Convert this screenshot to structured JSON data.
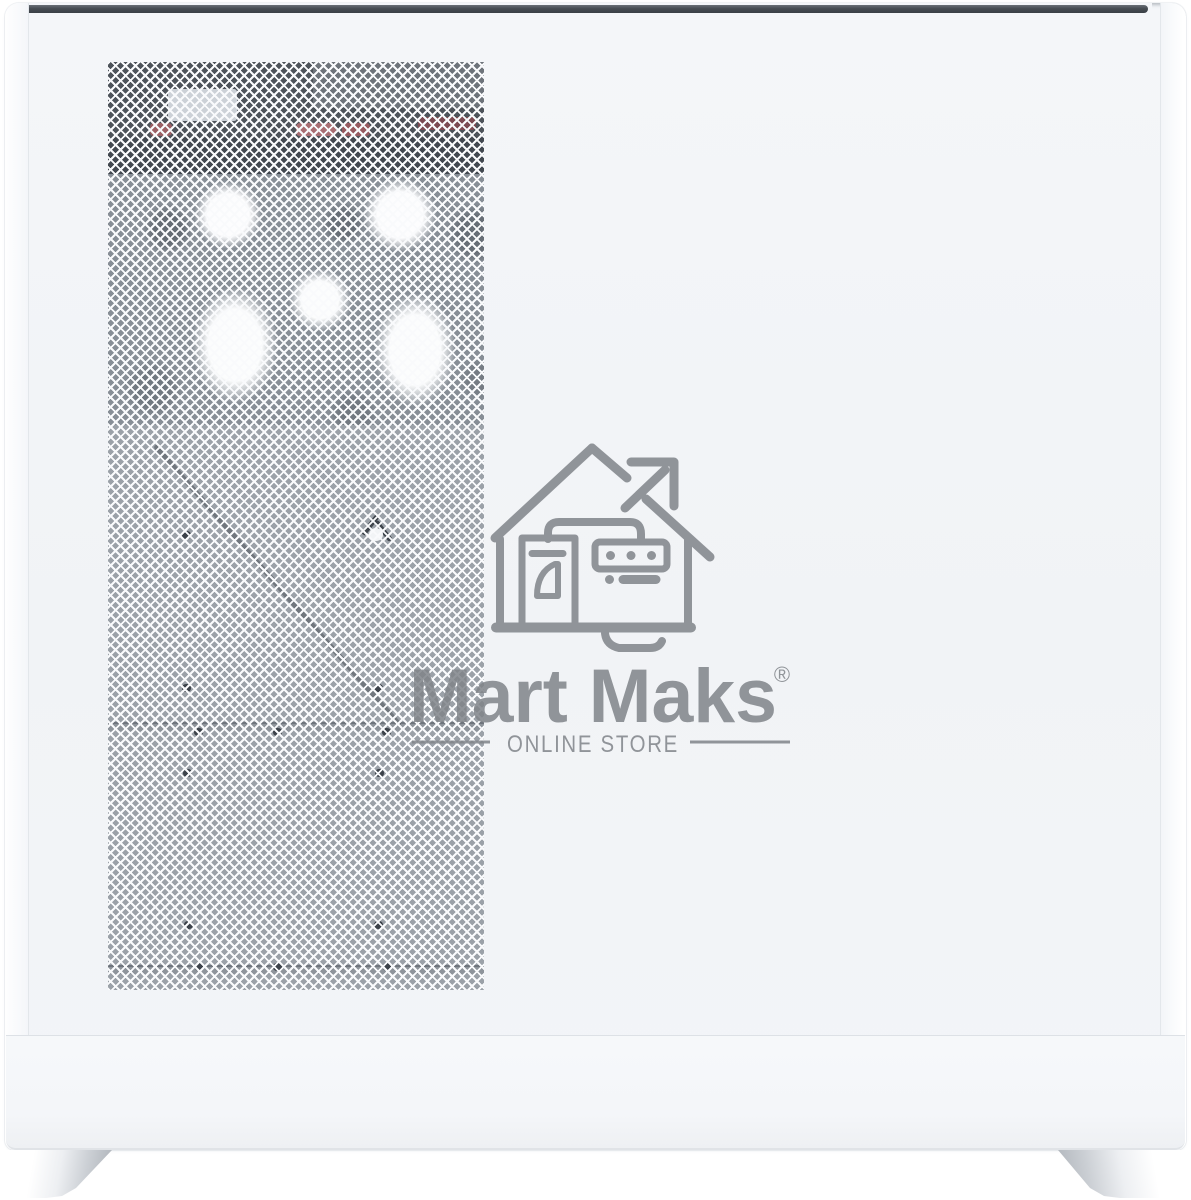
{
  "watermark": {
    "brand": "Mart Maks",
    "registered_mark": "®",
    "tagline": "ONLINE STORE",
    "logo_icon": "house-arrow-storefront-icon",
    "color": "#808489"
  },
  "product_photo": {
    "subject": "white PC tower case with diamond mesh side panel, fans visible through mesh",
    "colors": {
      "background": "#ffffff",
      "case_body": "#f2f4f7",
      "top_trim": "#464c53",
      "mesh_strand": "#f9fafc",
      "mesh_backing": "#9ba1a8",
      "interior_dark": "#4d535a",
      "fan_blade_white": "#fdfdfe",
      "cable_red": "#a86d72",
      "foot_shade": "#b4b9bf"
    }
  }
}
